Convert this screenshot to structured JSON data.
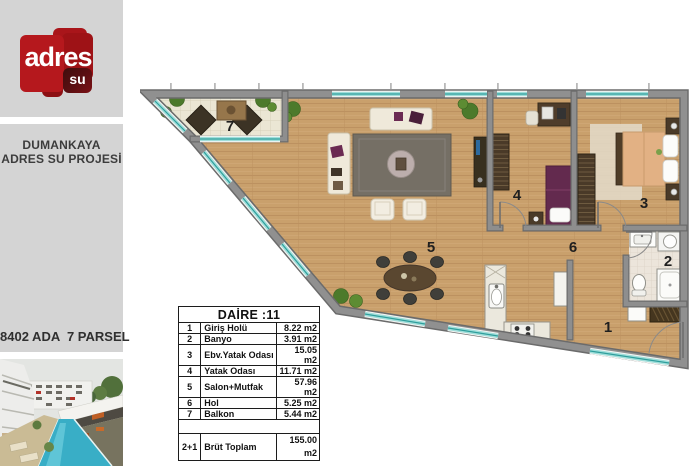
{
  "sidebar": {
    "logo": {
      "word": "adres",
      "sub": "su"
    },
    "project_line1": "DUMANKAYA",
    "project_line2": "ADRES SU PROJESİ",
    "parcel": "8402 ADA  7 PARSEL"
  },
  "plan": {
    "table": {
      "title": "DAİRE :11",
      "rows": [
        {
          "no": "1",
          "name": "Giriş Holü",
          "area": "8.22 m2"
        },
        {
          "no": "2",
          "name": "Banyo",
          "area": "3.91 m2"
        },
        {
          "no": "3",
          "name": "Ebv.Yatak Odası",
          "area": "15.05 m2"
        },
        {
          "no": "4",
          "name": "Yatak Odası",
          "area": "11.71 m2"
        },
        {
          "no": "5",
          "name": "Salon+Mutfak",
          "area": "57.96 m2"
        },
        {
          "no": "6",
          "name": "Hol",
          "area": "5.25 m2"
        },
        {
          "no": "7",
          "name": "Balkon",
          "area": "5.44 m2"
        }
      ],
      "total": {
        "no": "2+1",
        "name": "Brüt Toplam",
        "area": "155.00 m2"
      }
    }
  },
  "colors": {
    "accent_red": "#b5181d",
    "sidebar_gray": "#d4d4d4",
    "wall_gray": "#8e8e8e",
    "wood_floor": "#c9a06c",
    "window_teal": "#9fdeda",
    "pool_teal": "#39aec6"
  }
}
